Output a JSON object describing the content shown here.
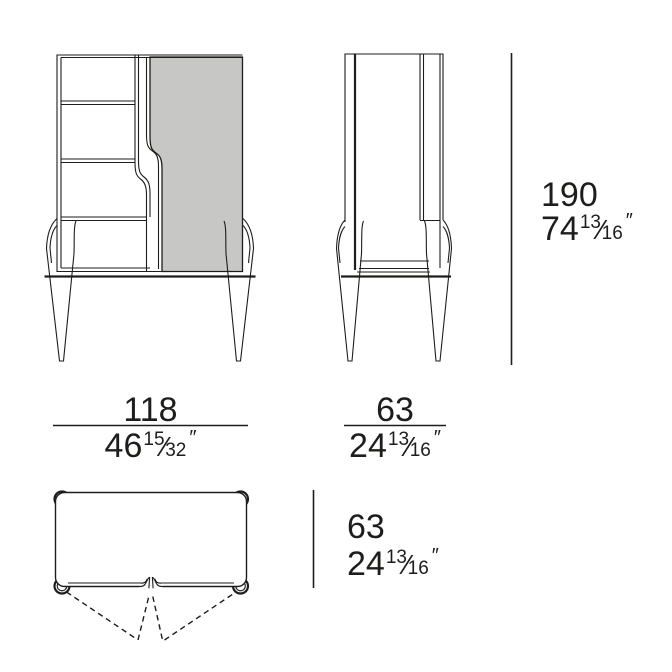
{
  "colors": {
    "background": "#ffffff",
    "line": "#1d1d1b",
    "text": "#1d1d1b",
    "panel_fill": "#c7c7c6"
  },
  "fraction_separator": "⁄",
  "dimensions": {
    "height": {
      "metric": "190",
      "imperial_whole": "74",
      "imperial_numerator": "13",
      "imperial_denominator": "16",
      "unit_mark": "″"
    },
    "width": {
      "metric": "118",
      "imperial_whole": "46",
      "imperial_numerator": "15",
      "imperial_denominator": "32",
      "unit_mark": "″"
    },
    "side_depth": {
      "metric": "63",
      "imperial_whole": "24",
      "imperial_numerator": "13",
      "imperial_denominator": "16",
      "unit_mark": "″"
    },
    "plan_depth": {
      "metric": "63",
      "imperial_whole": "24",
      "imperial_numerator": "13",
      "imperial_denominator": "16",
      "unit_mark": "″"
    }
  }
}
